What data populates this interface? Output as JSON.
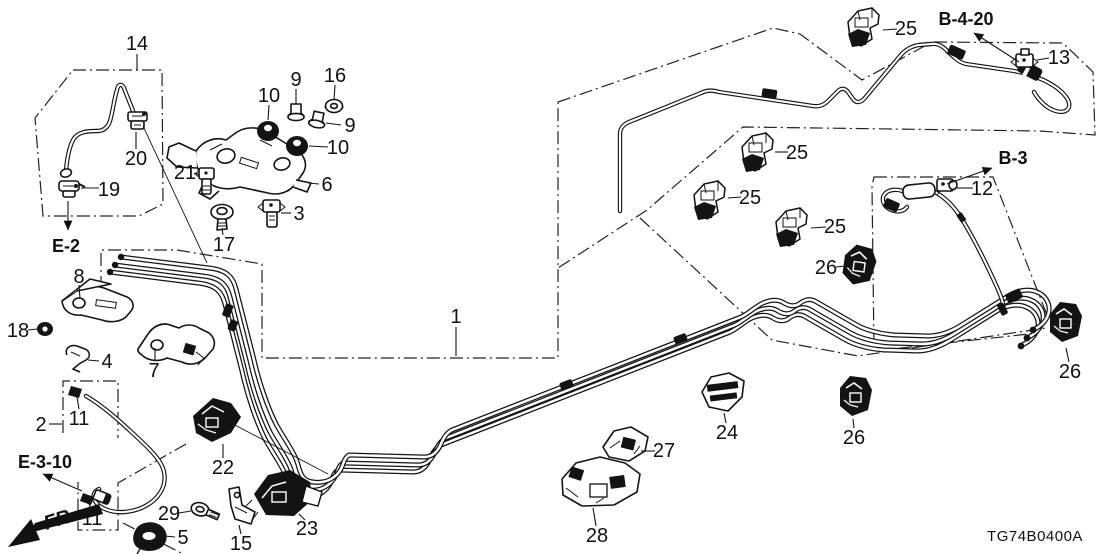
{
  "diagram": {
    "code": "TG74B0400A",
    "fr_label": "FR.",
    "callouts": [
      {
        "text": "14",
        "x": 137,
        "y": 43,
        "leaders": [
          [
            [
              137,
              54
            ],
            [
              137,
              70
            ]
          ]
        ]
      },
      {
        "text": "9",
        "x": 296,
        "y": 79,
        "leaders": [
          [
            [
              296,
              89
            ],
            [
              296,
              104
            ]
          ]
        ]
      },
      {
        "text": "16",
        "x": 335,
        "y": 75,
        "leaders": [
          [
            [
              335,
              85
            ],
            [
              334,
              100
            ]
          ]
        ]
      },
      {
        "text": "10",
        "x": 269,
        "y": 95,
        "leaders": [
          [
            [
              269,
              105
            ],
            [
              268,
              120
            ]
          ]
        ]
      },
      {
        "text": "9",
        "x": 350,
        "y": 125,
        "leaders": [
          [
            [
              341,
              125
            ],
            [
              326,
              123
            ]
          ]
        ]
      },
      {
        "text": "10",
        "x": 338,
        "y": 147,
        "leaders": [
          [
            [
              328,
              147
            ],
            [
              309,
              146
            ]
          ]
        ]
      },
      {
        "text": "20",
        "x": 136,
        "y": 158,
        "leaders": [
          [
            [
              136,
              149
            ],
            [
              136,
              132
            ]
          ]
        ]
      },
      {
        "text": "21",
        "x": 185,
        "y": 172,
        "leaders": [
          [
            [
              194,
              173
            ],
            [
              200,
              175
            ]
          ]
        ]
      },
      {
        "text": "19",
        "x": 109,
        "y": 189,
        "leaders": [
          [
            [
              99,
              188
            ],
            [
              81,
              188
            ]
          ]
        ]
      },
      {
        "text": "6",
        "x": 327,
        "y": 184,
        "leaders": [
          [
            [
              319,
              184
            ],
            [
              308,
              183
            ]
          ]
        ]
      },
      {
        "text": "3",
        "x": 299,
        "y": 213,
        "leaders": [
          [
            [
              291,
              213
            ],
            [
              281,
              213
            ]
          ]
        ]
      },
      {
        "text": "17",
        "x": 224,
        "y": 244,
        "leaders": [
          [
            [
              223,
              235
            ],
            [
              222,
              228
            ]
          ]
        ]
      },
      {
        "text": "8",
        "x": 79,
        "y": 276,
        "leaders": [
          [
            [
              79,
              285
            ],
            [
              80,
              299
            ]
          ]
        ]
      },
      {
        "text": "18",
        "x": 18,
        "y": 330,
        "leaders": [
          [
            [
              28,
              330
            ],
            [
              37,
              329
            ]
          ]
        ]
      },
      {
        "text": "4",
        "x": 107,
        "y": 361,
        "leaders": [
          [
            [
              99,
              361
            ],
            [
              88,
              360
            ]
          ]
        ]
      },
      {
        "text": "7",
        "x": 154,
        "y": 370,
        "leaders": [
          [
            [
              155,
              361
            ],
            [
              155,
              348
            ]
          ]
        ]
      },
      {
        "text": "2",
        "x": 41,
        "y": 424,
        "leaders": [
          [
            [
              49,
              424
            ],
            [
              62,
              424
            ]
          ]
        ]
      },
      {
        "text": "11",
        "x": 79,
        "y": 418,
        "leaders": [
          [
            [
              79,
              409
            ],
            [
              77,
              397
            ]
          ]
        ]
      },
      {
        "text": "11",
        "x": 92,
        "y": 518,
        "leaders": [
          [
            [
              91,
              509
            ],
            [
              88,
              501
            ]
          ]
        ]
      },
      {
        "text": "29",
        "x": 169,
        "y": 513,
        "leaders": [
          [
            [
              179,
              513
            ],
            [
              191,
              511
            ]
          ]
        ]
      },
      {
        "text": "5",
        "x": 183,
        "y": 537,
        "leaders": [
          [
            [
              175,
              537
            ],
            [
              165,
              536
            ]
          ]
        ]
      },
      {
        "text": "15",
        "x": 241,
        "y": 543,
        "leaders": [
          [
            [
              241,
              534
            ],
            [
              239,
              525
            ]
          ]
        ]
      },
      {
        "text": "23",
        "x": 307,
        "y": 528,
        "leaders": [
          [
            [
              305,
              520
            ],
            [
              299,
              514
            ]
          ]
        ]
      },
      {
        "text": "22",
        "x": 223,
        "y": 467,
        "leaders": [
          [
            [
              223,
              458
            ],
            [
              223,
              444
            ]
          ]
        ]
      },
      {
        "text": "1",
        "x": 456,
        "y": 316,
        "leaders": [
          [
            [
              456,
              327
            ],
            [
              456,
              356
            ]
          ]
        ]
      },
      {
        "text": "28",
        "x": 597,
        "y": 535,
        "leaders": [
          [
            [
              596,
              526
            ],
            [
              593,
              508
            ]
          ]
        ]
      },
      {
        "text": "27",
        "x": 664,
        "y": 450,
        "leaders": [
          [
            [
              655,
              451
            ],
            [
              641,
              451
            ]
          ]
        ]
      },
      {
        "text": "24",
        "x": 727,
        "y": 432,
        "leaders": [
          [
            [
              726,
              423
            ],
            [
              724,
              413
            ]
          ]
        ]
      },
      {
        "text": "26",
        "x": 854,
        "y": 437,
        "leaders": [
          [
            [
              854,
              428
            ],
            [
              853,
              419
            ]
          ]
        ]
      },
      {
        "text": "26",
        "x": 1070,
        "y": 371,
        "leaders": [
          [
            [
              1069,
              362
            ],
            [
              1066,
              348
            ]
          ]
        ]
      },
      {
        "text": "26",
        "x": 826,
        "y": 267,
        "leaders": [
          [
            [
              836,
              267
            ],
            [
              845,
              266
            ]
          ]
        ]
      },
      {
        "text": "25",
        "x": 906,
        "y": 28,
        "leaders": [
          [
            [
              897,
              29
            ],
            [
              883,
              30
            ]
          ]
        ]
      },
      {
        "text": "25",
        "x": 797,
        "y": 152,
        "leaders": [
          [
            [
              788,
              152
            ],
            [
              775,
              152
            ]
          ]
        ]
      },
      {
        "text": "25",
        "x": 750,
        "y": 197,
        "leaders": [
          [
            [
              741,
              197
            ],
            [
              728,
              198
            ]
          ]
        ]
      },
      {
        "text": "25",
        "x": 835,
        "y": 226,
        "leaders": [
          [
            [
              826,
              227
            ],
            [
              811,
              228
            ]
          ]
        ]
      },
      {
        "text": "12",
        "x": 982,
        "y": 188,
        "leaders": [
          [
            [
              973,
              188
            ],
            [
              957,
              188
            ]
          ]
        ]
      },
      {
        "text": "13",
        "x": 1059,
        "y": 57,
        "leaders": [
          [
            [
              1049,
              58
            ],
            [
              1037,
              60
            ]
          ]
        ]
      }
    ],
    "refs": [
      {
        "text": "E-2",
        "x": 66,
        "y": 246,
        "arrow": [
          [
            68,
            201
          ],
          [
            68,
            230
          ]
        ]
      },
      {
        "text": "E-3-10",
        "x": 45,
        "y": 462,
        "arrow": [
          [
            82,
            491
          ],
          [
            43,
            474
          ]
        ]
      },
      {
        "text": "B-4-20",
        "x": 966,
        "y": 19,
        "arrow": [
          [
            1019,
            62
          ],
          [
            974,
            33
          ]
        ]
      },
      {
        "text": "B-3",
        "x": 1013,
        "y": 158,
        "arrow": [
          [
            947,
            184
          ],
          [
            992,
            168
          ]
        ]
      }
    ]
  }
}
